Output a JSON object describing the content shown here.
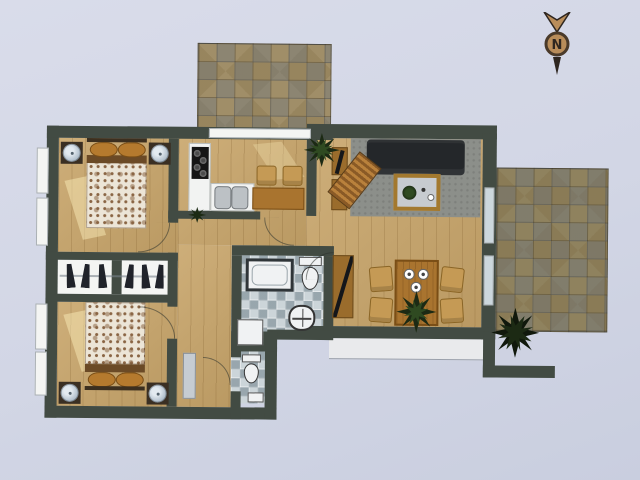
{
  "compass": {
    "label": "N"
  },
  "palette": {
    "background_top": "#d9dcea",
    "background_mid": "#d2d6e5",
    "background_bottom": "#c9cedf",
    "wall": "#424b43",
    "wood": "#c8a56a",
    "counter": "#f2f3f2",
    "cooktop": "#161616",
    "sink_steel": "#bcc1c5",
    "tile_tan": "#a08e68",
    "tile_olive": "#8f825e",
    "bath_tile_a": "#ccd5d9",
    "fixture_white": "#f0f2f3",
    "rug": "#8c8f8a",
    "sofa": "#24272a",
    "chair_tan": "#c59a55",
    "table_wood": "#a9742f",
    "sideboard": "#9a6c2c",
    "plant_dark": "#1c2a14",
    "plant_mid": "#2f4a21",
    "bed_floral_base": "#ece5d7",
    "bed_floral_dot": "#8a6544",
    "pillow": "#b57a2e",
    "nightstand": "#3a2f23",
    "lamp_blue": "#b7c4d0",
    "window_white": "#f4f5f3",
    "window_blue": "#ccd7dd",
    "terrace": "#e9eaec",
    "hall_cabinet": "#c6ccd2",
    "clothes_dark": "#20232a",
    "sun_patch": "rgba(255,242,190,0.45)",
    "compass_ring": "#4a3a2a",
    "compass_fill": "#b98d5a",
    "compass_dark": "#2e2620"
  },
  "scene": {
    "type": "apartment-floor-plan",
    "rooms": [
      {
        "name": "bedroom-top",
        "furniture": [
          "double-bed",
          "nightstand-left",
          "nightstand-right"
        ]
      },
      {
        "name": "wardrobe-closet",
        "furniture": [
          "hanging-clothes-left",
          "hanging-clothes-right"
        ]
      },
      {
        "name": "bedroom-bottom",
        "furniture": [
          "double-bed",
          "nightstand-left",
          "nightstand-right"
        ]
      },
      {
        "name": "hallway",
        "furniture": [
          "hall-cabinet"
        ]
      },
      {
        "name": "kitchen",
        "furniture": [
          "l-counter",
          "cooktop",
          "double-sink",
          "table",
          "chair",
          "chair",
          "plant"
        ]
      },
      {
        "name": "bathroom",
        "furniture": [
          "bathtub",
          "toilet",
          "washbasin",
          "washer-box"
        ]
      },
      {
        "name": "wc",
        "furniture": [
          "toilet",
          "small-basin"
        ]
      },
      {
        "name": "living-room",
        "furniture": [
          "sofa",
          "rug",
          "coffee-table",
          "lounger",
          "tv-cabinet",
          "corner-plant"
        ]
      },
      {
        "name": "dining-area",
        "furniture": [
          "dining-table",
          "chair",
          "chair",
          "chair",
          "chair",
          "plates",
          "plant",
          "sideboard"
        ]
      },
      {
        "name": "patio-top",
        "furniture": []
      },
      {
        "name": "patio-right",
        "furniture": []
      },
      {
        "name": "entry-walkway",
        "furniture": [
          "bush"
        ]
      }
    ]
  }
}
